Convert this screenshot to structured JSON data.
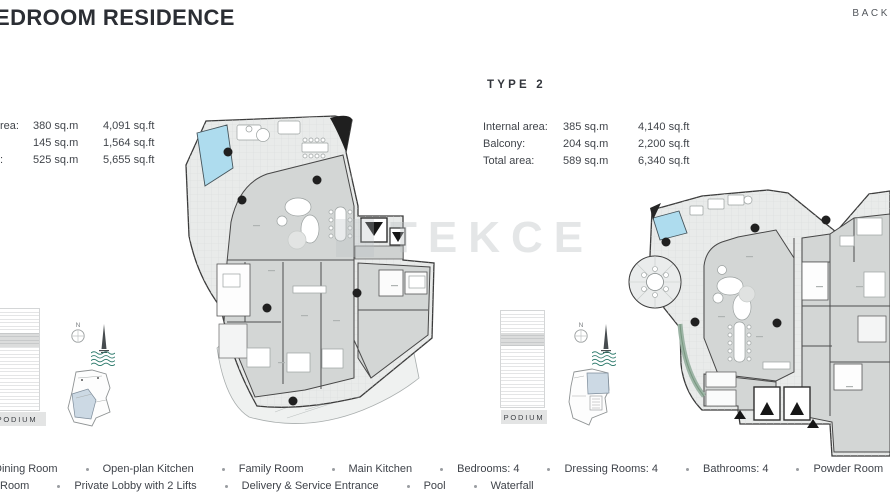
{
  "header": {
    "title": "EDROOM RESIDENCE",
    "back_label": "BACK"
  },
  "watermark": {
    "text": "TEKCE"
  },
  "misc": {
    "compass_n": "N"
  },
  "type1": {
    "area_rows": [
      {
        "label": "rea:",
        "sqm": "380 sq.m",
        "sqft": "4,091 sq.ft"
      },
      {
        "label": "",
        "sqm": "145 sq.m",
        "sqft": "1,564 sq.ft"
      },
      {
        "label": ":",
        "sqm": "525 sq.m",
        "sqft": "5,655 sq.ft"
      }
    ],
    "podium_label": "PODIUM"
  },
  "type2": {
    "heading": "TYPE 2",
    "area_rows": [
      {
        "label": "Internal area:",
        "sqm": "385 sq.m",
        "sqft": "4,140 sq.ft"
      },
      {
        "label": "Balcony:",
        "sqm": "204 sq.m",
        "sqft": "2,200 sq.ft"
      },
      {
        "label": "Total area:",
        "sqm": "589 sq.m",
        "sqft": "6,340 sq.ft"
      }
    ],
    "podium_label": "PODIUM"
  },
  "legend": {
    "row1": [
      "Dining Room",
      "Open-plan Kitchen",
      "Family Room",
      "Main Kitchen",
      "Bedrooms: 4",
      "Dressing Rooms: 4",
      "Bathrooms: 4",
      "Powder Room"
    ],
    "row2": [
      "Room",
      "Private Lobby with 2 Lifts",
      "Delivery & Service Entrance",
      "Pool",
      "Waterfall"
    ]
  },
  "colors": {
    "pool": "#aedcee",
    "interior": "#d3d6d5",
    "terrace": "#e9ebea",
    "wall": "#3b3b3b",
    "waves_icon": "#2f7b6d",
    "keyplan_highlight": "#ccd9e4",
    "title_text": "#2b2e34"
  }
}
